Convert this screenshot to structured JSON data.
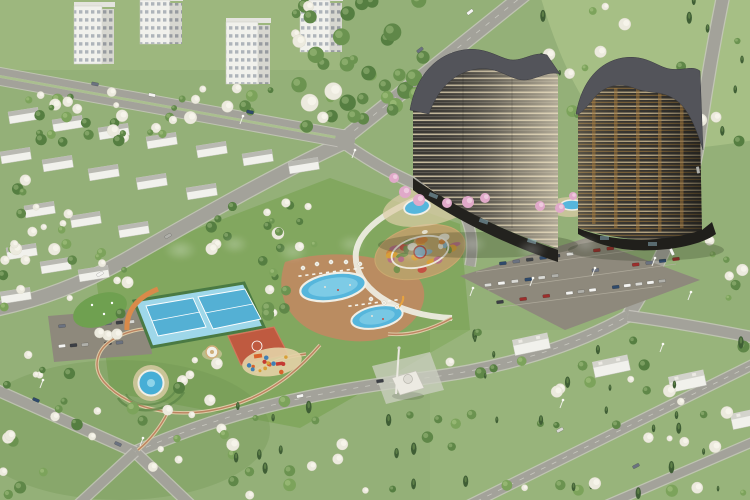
{
  "image": {
    "kind": "aerial-architectural-render",
    "subject": "Residential complex render: two curved dark high-rise towers with wavy grey roofs, landscaped central park with an oval ornamental flower garden, oval swimming pools with loungers and umbrellas, two light-blue tennis courts, a red basketball court, playground, large surface car park, small mosque with minaret, surrounded by low-rise white suburban apartment blocks and flat-roof villas among dense spring trees",
    "camera": "high oblique aerial view",
    "season": "spring with white and pink blossoming trees"
  },
  "watermark": {
    "style": "faint-translucent-white-logo",
    "legible": false,
    "color": "#ffffff",
    "opacity": 0.2
  },
  "palette": {
    "grass_base": "#94b078",
    "grass_light": "#a9c287",
    "grass_park": "#7fa65c",
    "grass_dark": "#6d9150",
    "road": "#a3a29a",
    "road_edge": "#c9c8c0",
    "road_median": "#aabf8f",
    "parking": "#8e897c",
    "parking_line": "#b7b2a3",
    "tower_dark": "#3a3834",
    "tower_dark2": "#35332f",
    "tower_cream": "#d9cfb4",
    "tower_amber": "#a77b3d",
    "roof_grey": "#53545a",
    "roof_flat": "#b9b9b2",
    "pool_water": "#56b6dc",
    "pool_water_light": "#8ed4ea",
    "pool_rim": "#f1efe6",
    "deck_sand": "#ddcda6",
    "deck_terracotta": "#c08a62",
    "court_surround": "#9ed7e9",
    "court_blue": "#54b0d4",
    "court_green": "#4a7a43",
    "basket_red": "#bf5a40",
    "flower_bed": "#b9a06a",
    "path_tan": "#dccba6",
    "path_red": "#b5714f",
    "path_white": "#ecebdf",
    "tree_dark": "#3f5e35",
    "tree_green": "#5f8748",
    "tree_light": "#7ca35b",
    "tree_blossom": "#eceade",
    "tree_pink": "#e0a9c9",
    "building_white": "#f1f1ec",
    "building_side": "#d7d7d0",
    "arcade_orange": "#d98a4a",
    "fountain": "#47aed6",
    "sand": "#e3d2a6",
    "car_colors": [
      "#f4f4f1",
      "#3c3f45",
      "#9c2f2c",
      "#6b7280",
      "#d9d9d4",
      "#2f4a6b",
      "#b0b0aa",
      "#f4f4f1"
    ],
    "flower_colors": [
      "#c4483f",
      "#d9a036",
      "#e8e4d6",
      "#6f8f4a",
      "#b56a8a",
      "#86b0c8",
      "#cf7f3a"
    ],
    "play_colors": [
      "#d9622b",
      "#c43a32",
      "#3f7fb5",
      "#d9a036"
    ]
  },
  "features": [
    {
      "name": "left-tower",
      "desc": "tall dark residential tower with wavy grey roof and cream balcony bands"
    },
    {
      "name": "right-tower",
      "desc": "tall dark residential tower with wavy grey roof and amber window strips"
    },
    {
      "name": "flower-garden",
      "desc": "oval ornamental parterre with multicoloured beds and central medallion"
    },
    {
      "name": "main-pool",
      "desc": "large oval swimming pool with loungers and white umbrellas"
    },
    {
      "name": "second-pool",
      "desc": "oval leisure pool with slide"
    },
    {
      "name": "tower-plaza-pool",
      "desc": "round pool on the tower plaza"
    },
    {
      "name": "plaza-fountain-pool",
      "desc": "round fountain pool in the west garden"
    },
    {
      "name": "tennis-courts",
      "desc": "two light-blue tennis courts with green edging"
    },
    {
      "name": "basketball-court",
      "desc": "red outdoor basketball court"
    },
    {
      "name": "playground",
      "desc": "children playground with colourful equipment"
    },
    {
      "name": "main-parking",
      "desc": "large surface car park with angled rows of cars"
    },
    {
      "name": "west-parking",
      "desc": "small roadside car park"
    },
    {
      "name": "mosque",
      "desc": "small white mosque with a single minaret"
    },
    {
      "name": "villa-district",
      "desc": "white flat-roof villas among trees in lower right"
    },
    {
      "name": "apartment-district",
      "desc": "white mid-rise apartment blocks in upper left"
    },
    {
      "name": "promenade",
      "desc": "white curved promenade around the flower garden"
    },
    {
      "name": "orange-arcade",
      "desc": "orange arched wall along the tennis courts"
    }
  ],
  "counts": {
    "towers": 2,
    "tennis_courts": 2,
    "oval_pools": 2,
    "round_pools": 2,
    "white_apartment_towers": 4
  }
}
